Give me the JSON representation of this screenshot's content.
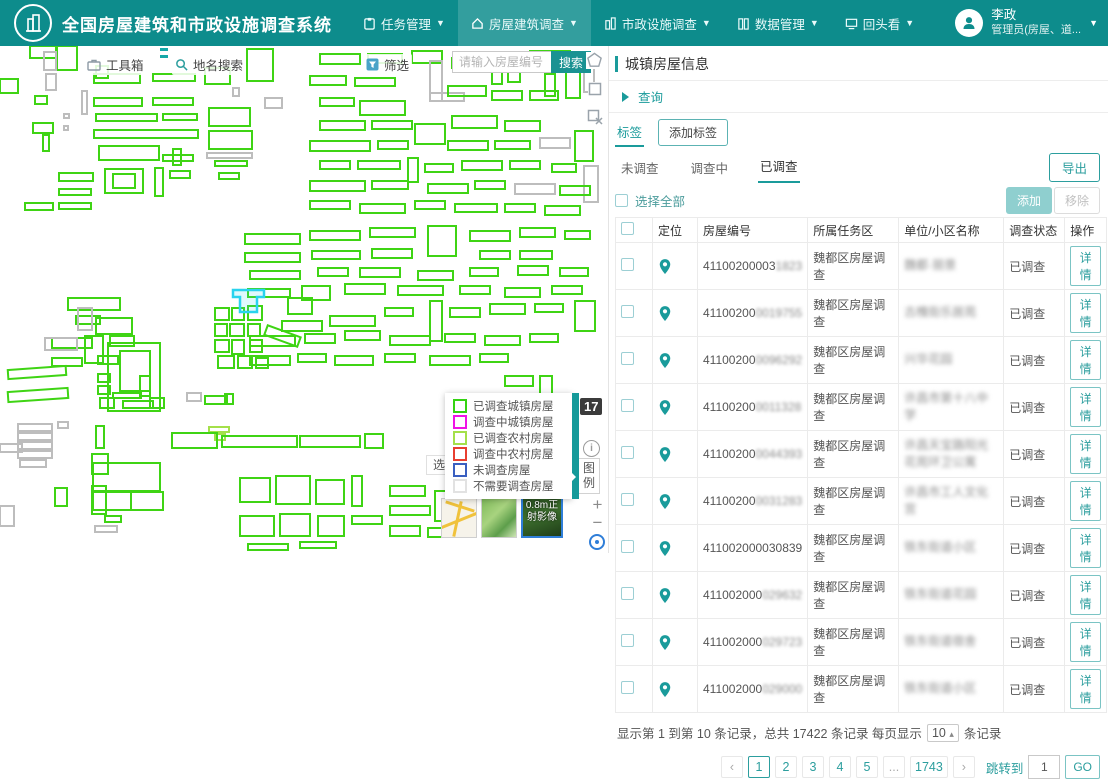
{
  "header": {
    "title": "全国房屋建筑和市政设施调查系统",
    "menus": [
      {
        "label": "任务管理"
      },
      {
        "label": "房屋建筑调查"
      },
      {
        "label": "市政设施调查"
      },
      {
        "label": "数据管理"
      },
      {
        "label": "回头看"
      }
    ],
    "user": {
      "name": "李政",
      "role": "管理员(房屋、道..."
    }
  },
  "map": {
    "toolbar": {
      "toolbox": "工具箱",
      "place_search": "地名搜索",
      "filter": "筛选",
      "search_placeholder": "请输入房屋编号",
      "search_button": "搜索"
    },
    "zoom_level": "17",
    "info_glyph": "i",
    "legend_button": "图例",
    "select_tool": "选",
    "zoom_in": "+",
    "zoom_out": "−",
    "basemap_label_line1": "0.8m正",
    "basemap_label_line2": "射影像",
    "legend_items": [
      {
        "label": "已调查城镇房屋",
        "color": "#35d312"
      },
      {
        "label": "调查中城镇房屋",
        "color": "#f012e6"
      },
      {
        "label": "已调查农村房屋",
        "color": "#a4e04a"
      },
      {
        "label": "调查中农村房屋",
        "color": "#e83f30"
      },
      {
        "label": "未调查房屋",
        "color": "#3a5fc0"
      },
      {
        "label": "不需要调查房屋",
        "color": "#e2e2e2"
      }
    ],
    "colors": {
      "g": "#3fd414",
      "e": "#bdbdbd",
      "y": "#a4e04a",
      "hl": "#29d3ee",
      "dash": "#16a8a8"
    },
    "highlight_polygon": "233,244 264,244 264,251 257,251 257,266 240,266 240,251 233,251",
    "dashes": [
      [
        160,
        2,
        8,
        3
      ],
      [
        160,
        9,
        8,
        3
      ]
    ],
    "buildings": [
      [
        30,
        0,
        26,
        12
      ],
      [
        57,
        0,
        20,
        24
      ],
      [
        96,
        20,
        12,
        12
      ],
      [
        0,
        33,
        18,
        14
      ],
      [
        35,
        50,
        12,
        8
      ],
      [
        33,
        77,
        20,
        10
      ],
      [
        43,
        89,
        6,
        16
      ],
      [
        44,
        6,
        12,
        18,
        "e"
      ],
      [
        46,
        28,
        10,
        16,
        "e"
      ],
      [
        82,
        45,
        5,
        23,
        "e"
      ],
      [
        64,
        68,
        5,
        4,
        "e"
      ],
      [
        64,
        80,
        4,
        4,
        "e"
      ],
      [
        94,
        28,
        46,
        9
      ],
      [
        153,
        28,
        42,
        7
      ],
      [
        94,
        52,
        48,
        8
      ],
      [
        153,
        52,
        40,
        7
      ],
      [
        96,
        68,
        61,
        7
      ],
      [
        163,
        68,
        34,
        6
      ],
      [
        94,
        84,
        104,
        8
      ],
      [
        99,
        100,
        60,
        14
      ],
      [
        163,
        109,
        30,
        6
      ],
      [
        173,
        103,
        8,
        16
      ],
      [
        59,
        127,
        34,
        8
      ],
      [
        59,
        143,
        32,
        6
      ],
      [
        59,
        157,
        32,
        6
      ],
      [
        25,
        157,
        28,
        7
      ],
      [
        105,
        123,
        38,
        24
      ],
      [
        113,
        128,
        22,
        14
      ],
      [
        155,
        122,
        8,
        28
      ],
      [
        170,
        125,
        20,
        7
      ],
      [
        247,
        3,
        26,
        32
      ],
      [
        205,
        22,
        25,
        16
      ],
      [
        265,
        52,
        17,
        10,
        "e"
      ],
      [
        209,
        62,
        41,
        18
      ],
      [
        209,
        85,
        43,
        18
      ],
      [
        207,
        107,
        45,
        5,
        "e"
      ],
      [
        215,
        115,
        32,
        5
      ],
      [
        219,
        127,
        20,
        6
      ],
      [
        233,
        42,
        6,
        8,
        "e"
      ],
      [
        320,
        8,
        40,
        10
      ],
      [
        368,
        8,
        34,
        9
      ],
      [
        412,
        5,
        30,
        12
      ],
      [
        310,
        30,
        36,
        9
      ],
      [
        355,
        32,
        40,
        8
      ],
      [
        320,
        52,
        34,
        8
      ],
      [
        360,
        55,
        45,
        14
      ],
      [
        430,
        15,
        12,
        40,
        "e"
      ],
      [
        430,
        47,
        34,
        8,
        "e"
      ],
      [
        452,
        12,
        34,
        10
      ],
      [
        492,
        8,
        10,
        30
      ],
      [
        508,
        10,
        12,
        26
      ],
      [
        530,
        5,
        40,
        12
      ],
      [
        545,
        28,
        10,
        22
      ],
      [
        448,
        40,
        38,
        10
      ],
      [
        492,
        45,
        30,
        9
      ],
      [
        530,
        45,
        28,
        9
      ],
      [
        566,
        12,
        14,
        40
      ],
      [
        584,
        16,
        10,
        30,
        "e"
      ],
      [
        320,
        75,
        45,
        9
      ],
      [
        372,
        75,
        40,
        8
      ],
      [
        415,
        78,
        30,
        20
      ],
      [
        452,
        70,
        45,
        12
      ],
      [
        505,
        75,
        35,
        10
      ],
      [
        310,
        95,
        60,
        10
      ],
      [
        378,
        95,
        30,
        8
      ],
      [
        448,
        95,
        40,
        9
      ],
      [
        495,
        95,
        35,
        8
      ],
      [
        540,
        92,
        30,
        10,
        "e"
      ],
      [
        575,
        85,
        18,
        30
      ],
      [
        320,
        115,
        30,
        8
      ],
      [
        358,
        115,
        42,
        8
      ],
      [
        408,
        112,
        10,
        24
      ],
      [
        425,
        118,
        28,
        8
      ],
      [
        462,
        115,
        40,
        9
      ],
      [
        510,
        115,
        30,
        8
      ],
      [
        552,
        118,
        24,
        8
      ],
      [
        584,
        120,
        14,
        36,
        "e"
      ],
      [
        310,
        135,
        55,
        10
      ],
      [
        372,
        135,
        36,
        8
      ],
      [
        428,
        138,
        40,
        9
      ],
      [
        475,
        135,
        30,
        8
      ],
      [
        515,
        138,
        40,
        10,
        "e"
      ],
      [
        560,
        140,
        30,
        9
      ],
      [
        310,
        155,
        40,
        8
      ],
      [
        360,
        158,
        45,
        9
      ],
      [
        415,
        155,
        30,
        8
      ],
      [
        455,
        158,
        42,
        8
      ],
      [
        505,
        158,
        30,
        8
      ],
      [
        545,
        160,
        35,
        9
      ],
      [
        245,
        188,
        55,
        10
      ],
      [
        310,
        185,
        50,
        9
      ],
      [
        370,
        182,
        45,
        9
      ],
      [
        428,
        180,
        28,
        30
      ],
      [
        470,
        185,
        40,
        10
      ],
      [
        520,
        182,
        35,
        9
      ],
      [
        565,
        185,
        25,
        8
      ],
      [
        245,
        207,
        55,
        9
      ],
      [
        312,
        205,
        48,
        8
      ],
      [
        372,
        203,
        40,
        9
      ],
      [
        480,
        205,
        30,
        8
      ],
      [
        520,
        205,
        32,
        8
      ],
      [
        250,
        225,
        50,
        8
      ],
      [
        318,
        222,
        30,
        8
      ],
      [
        360,
        222,
        40,
        9
      ],
      [
        418,
        225,
        35,
        9
      ],
      [
        470,
        222,
        28,
        8
      ],
      [
        518,
        220,
        30,
        9
      ],
      [
        560,
        222,
        28,
        8
      ],
      [
        248,
        243,
        42,
        8
      ],
      [
        302,
        240,
        28,
        14
      ],
      [
        345,
        238,
        40,
        10
      ],
      [
        398,
        240,
        45,
        9
      ],
      [
        460,
        240,
        30,
        8
      ],
      [
        505,
        242,
        35,
        9
      ],
      [
        552,
        240,
        30,
        8
      ],
      [
        68,
        252,
        52,
        12
      ],
      [
        76,
        270,
        24,
        8
      ],
      [
        78,
        262,
        14,
        22,
        "e"
      ],
      [
        96,
        272,
        36,
        16
      ],
      [
        110,
        290,
        24,
        10
      ],
      [
        52,
        292,
        40,
        10
      ],
      [
        98,
        310,
        20,
        8
      ],
      [
        52,
        312,
        30,
        8
      ],
      [
        288,
        252,
        24,
        16
      ],
      [
        282,
        275,
        40,
        10
      ],
      [
        330,
        270,
        45,
        10
      ],
      [
        385,
        262,
        28,
        8
      ],
      [
        430,
        255,
        12,
        40
      ],
      [
        450,
        262,
        30,
        9
      ],
      [
        490,
        258,
        35,
        10
      ],
      [
        535,
        258,
        28,
        8
      ],
      [
        575,
        255,
        20,
        30
      ],
      [
        250,
        290,
        45,
        10
      ],
      [
        305,
        288,
        30,
        9
      ],
      [
        345,
        285,
        35,
        9
      ],
      [
        390,
        290,
        40,
        9
      ],
      [
        445,
        288,
        30,
        8
      ],
      [
        485,
        290,
        35,
        9
      ],
      [
        530,
        288,
        28,
        8
      ],
      [
        250,
        310,
        40,
        9
      ],
      [
        298,
        308,
        28,
        8
      ],
      [
        335,
        310,
        38,
        9
      ],
      [
        385,
        308,
        30,
        8
      ],
      [
        430,
        310,
        40,
        9
      ],
      [
        480,
        308,
        28,
        8
      ],
      [
        215,
        262,
        14,
        12
      ],
      [
        232,
        262,
        12,
        12
      ],
      [
        248,
        260,
        14,
        14
      ],
      [
        215,
        278,
        12,
        12
      ],
      [
        230,
        278,
        14,
        12
      ],
      [
        248,
        278,
        12,
        12
      ],
      [
        215,
        294,
        14,
        12
      ],
      [
        232,
        294,
        12,
        14
      ],
      [
        250,
        294,
        12,
        12
      ],
      [
        265,
        285,
        35,
        10,
        null,
        20
      ],
      [
        218,
        310,
        16,
        12
      ],
      [
        238,
        310,
        14,
        12
      ],
      [
        256,
        312,
        12,
        10
      ],
      [
        8,
        322,
        58,
        9,
        null,
        -4
      ],
      [
        8,
        344,
        60,
        10,
        null,
        -4
      ],
      [
        45,
        292,
        32,
        12,
        "e"
      ],
      [
        18,
        378,
        34,
        7,
        "e"
      ],
      [
        18,
        387,
        34,
        7,
        "e"
      ],
      [
        18,
        396,
        34,
        7,
        "e"
      ],
      [
        18,
        405,
        34,
        7,
        "e"
      ],
      [
        20,
        414,
        26,
        7,
        "e"
      ],
      [
        58,
        376,
        10,
        6,
        "e"
      ],
      [
        96,
        380,
        8,
        22
      ],
      [
        92,
        408,
        16,
        20
      ],
      [
        0,
        398,
        22,
        8,
        "e"
      ],
      [
        92,
        440,
        14,
        28
      ],
      [
        55,
        442,
        12,
        18
      ],
      [
        140,
        330,
        10,
        20
      ],
      [
        150,
        352,
        14,
        10
      ],
      [
        0,
        460,
        14,
        20,
        "e"
      ],
      [
        85,
        290,
        18,
        27
      ],
      [
        108,
        297,
        52,
        68
      ],
      [
        120,
        305,
        30,
        40
      ],
      [
        98,
        328,
        12,
        8
      ],
      [
        98,
        340,
        12,
        8
      ],
      [
        100,
        352,
        14,
        10
      ],
      [
        113,
        347,
        28,
        5
      ],
      [
        123,
        355,
        30,
        7
      ],
      [
        187,
        347,
        14,
        8,
        "e"
      ],
      [
        205,
        350,
        22,
        8
      ],
      [
        225,
        348,
        8,
        10
      ],
      [
        209,
        381,
        20,
        5,
        "y"
      ],
      [
        215,
        388,
        10,
        6,
        "y"
      ],
      [
        172,
        387,
        45,
        15
      ],
      [
        222,
        390,
        75,
        11
      ],
      [
        300,
        390,
        60,
        11
      ],
      [
        365,
        388,
        18,
        14
      ],
      [
        93,
        417,
        67,
        28
      ],
      [
        93,
        446,
        38,
        18
      ],
      [
        131,
        446,
        32,
        18
      ],
      [
        105,
        470,
        16,
        6
      ],
      [
        95,
        480,
        22,
        6,
        "e"
      ],
      [
        240,
        432,
        30,
        24
      ],
      [
        276,
        430,
        34,
        28
      ],
      [
        316,
        434,
        28,
        24
      ],
      [
        352,
        430,
        10,
        30
      ],
      [
        240,
        470,
        34,
        20
      ],
      [
        280,
        468,
        30,
        22
      ],
      [
        318,
        470,
        26,
        20
      ],
      [
        352,
        470,
        30,
        8
      ],
      [
        390,
        440,
        35,
        10
      ],
      [
        390,
        460,
        40,
        9
      ],
      [
        435,
        445,
        12,
        30
      ],
      [
        390,
        480,
        30,
        10
      ],
      [
        428,
        482,
        34,
        9
      ],
      [
        248,
        498,
        40,
        6
      ],
      [
        300,
        496,
        36,
        6
      ],
      [
        505,
        330,
        28,
        10
      ],
      [
        505,
        348,
        30,
        9
      ],
      [
        540,
        330,
        12,
        28
      ],
      [
        505,
        368,
        26,
        9
      ],
      [
        540,
        365,
        25,
        8
      ]
    ]
  },
  "panel": {
    "title": "城镇房屋信息",
    "query": "查询",
    "tag_tab": "标签",
    "add_tag": "添加标签",
    "tabs": [
      {
        "label": "未调查"
      },
      {
        "label": "调查中"
      },
      {
        "label": "已调查",
        "active": true
      }
    ],
    "export": "导出",
    "select_all": "选择全部",
    "add": "添加",
    "remove": "移除",
    "table": {
      "columns": [
        "定位",
        "房屋编号",
        "所属任务区",
        "单位/小区名称",
        "调查状态",
        "操作"
      ],
      "detail": "详情",
      "rows": [
        {
          "num": "41100200003",
          "num_blur": "1823",
          "area": "魏都区房屋调查",
          "name": "魏都·丽景",
          "status": "已调查"
        },
        {
          "num": "41100200",
          "num_blur": "0019755",
          "area": "魏都区房屋调查",
          "name": "古槐街乐居苑",
          "status": "已调查"
        },
        {
          "num": "41100200",
          "num_blur": "0096292",
          "area": "魏都区房屋调查",
          "name": "兴华花园",
          "status": "已调查"
        },
        {
          "num": "41100200",
          "num_blur": "0011328",
          "area": "魏都区房屋调查",
          "name": "许昌市第十八中学",
          "status": "已调查"
        },
        {
          "num": "41100200",
          "num_blur": "0044393",
          "area": "魏都区房屋调查",
          "name": "许昌天宝路阳光花苑环卫公寓",
          "status": "已调查"
        },
        {
          "num": "41100200",
          "num_blur": "0031283",
          "area": "魏都区房屋调查",
          "name": "许昌市工人文化宫",
          "status": "已调查"
        },
        {
          "num": "411002000030839",
          "num_blur": "",
          "area": "魏都区房屋调查",
          "name": "铁东街道小区",
          "status": "已调查"
        },
        {
          "num": "411002000",
          "num_blur": "029632",
          "area": "魏都区房屋调查",
          "name": "铁东街道花园",
          "status": "已调查"
        },
        {
          "num": "411002000",
          "num_blur": "029723",
          "area": "魏都区房屋调查",
          "name": "铁东街道宿舍",
          "status": "已调查"
        },
        {
          "num": "411002000",
          "num_blur": "029000",
          "area": "魏都区房屋调查",
          "name": "铁东街道小区",
          "status": "已调查"
        }
      ]
    },
    "footer": {
      "info_prefix": "显示第 1 到第 10 条记录，总共 17422 条记录 每页显示",
      "page_size": "10",
      "size_caret": "▴",
      "info_suffix": "条记录",
      "pages": [
        "‹",
        "1",
        "2",
        "3",
        "4",
        "5",
        "...",
        "1743",
        "›"
      ],
      "current_page": "1",
      "jump_label": "跳转到",
      "jump_value": "1",
      "go": "GO"
    }
  }
}
